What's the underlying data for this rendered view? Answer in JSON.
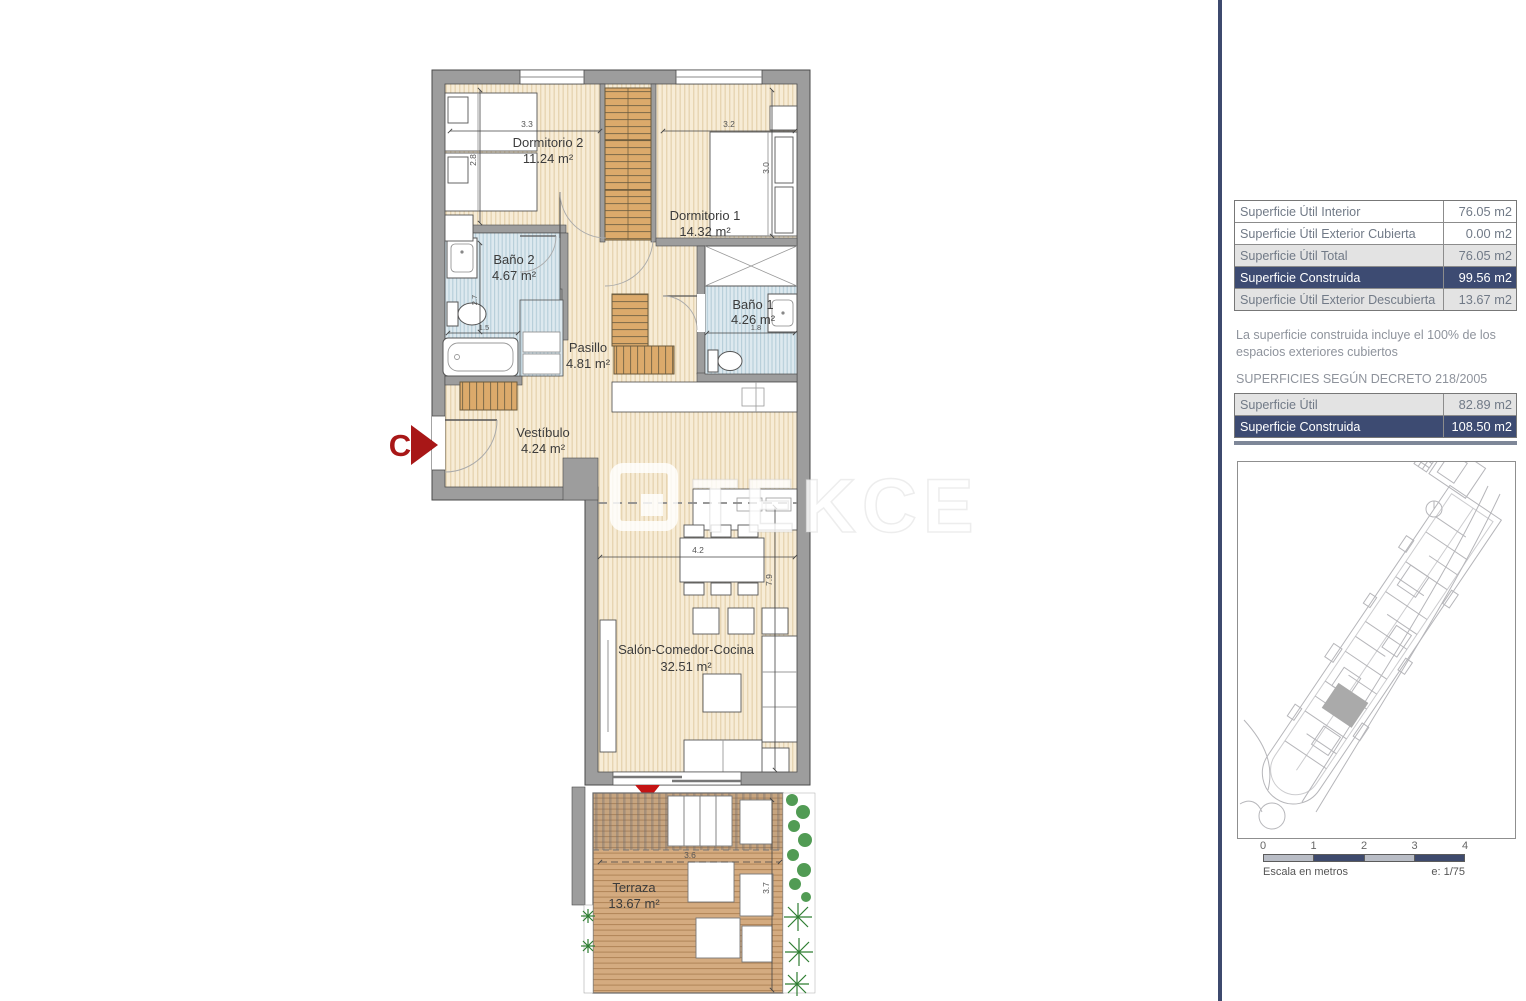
{
  "plan": {
    "rooms": [
      {
        "name": "Dormitorio 2",
        "area": "11.24 m²"
      },
      {
        "name": "Dormitorio 1",
        "area": "14.32 m²"
      },
      {
        "name": "Baño 2",
        "area": "4.67 m²"
      },
      {
        "name": "Baño 1",
        "area": "4.26 m²"
      },
      {
        "name": "Pasillo",
        "area": "4.81 m²"
      },
      {
        "name": "Vestíbulo",
        "area": "4.24 m²"
      },
      {
        "name": "Salón-Comedor-Cocina",
        "area": "32.51 m²"
      },
      {
        "name": "Terraza",
        "area": "13.67 m²"
      }
    ],
    "dimensions": {
      "dorm2_w": "3.3",
      "dorm2_h": "2.8",
      "dorm1_w": "3.2",
      "dorm1_h": "3.0",
      "bano2_h": "2.7",
      "bano2_w": "1.5",
      "bano1_w": "1.8",
      "salon_w": "4.2",
      "salon_h": "7.9",
      "terraza_w": "3.6",
      "terraza_h": "3.7"
    },
    "entrance_label": "C",
    "watermark": "TEKCE"
  },
  "panel": {
    "main_table": {
      "rows": [
        {
          "label": "Superficie Útil Interior",
          "value": "76.05 m2"
        },
        {
          "label": "Superficie Útil Exterior Cubierta",
          "value": "0.00 m2"
        },
        {
          "label": "Superficie Útil Total",
          "value": "76.05 m2"
        },
        {
          "label": "Superficie Construida",
          "value": "99.56 m2"
        },
        {
          "label": "Superficie Útil Exterior Descubierta",
          "value": "13.67 m2"
        }
      ]
    },
    "note": "La superficie construida incluye el 100% de los espacios exteriores cubiertos",
    "decree_heading": "SUPERFICIES SEGÚN DECRETO 218/2005",
    "decree_table": {
      "rows": [
        {
          "label": "Superficie Útil",
          "value": "82.89 m2"
        },
        {
          "label": "Superficie Construida",
          "value": "108.50 m2"
        }
      ]
    },
    "scale_bar": {
      "ticks": [
        "0",
        "1",
        "2",
        "3",
        "4"
      ],
      "caption": "Escala en metros",
      "ratio": "e: 1/75"
    }
  },
  "colors": {
    "accent_navy": "#3D4B72",
    "row_gray": "#E3E3E3",
    "entrance_red": "#A81717",
    "wall_gray": "#9D9D9D",
    "tile_blue": "#DDE9EF",
    "wood_floor": "#F7ECD6",
    "deck_brown": "#D4AB80",
    "plant_green": "#2F8A34"
  }
}
